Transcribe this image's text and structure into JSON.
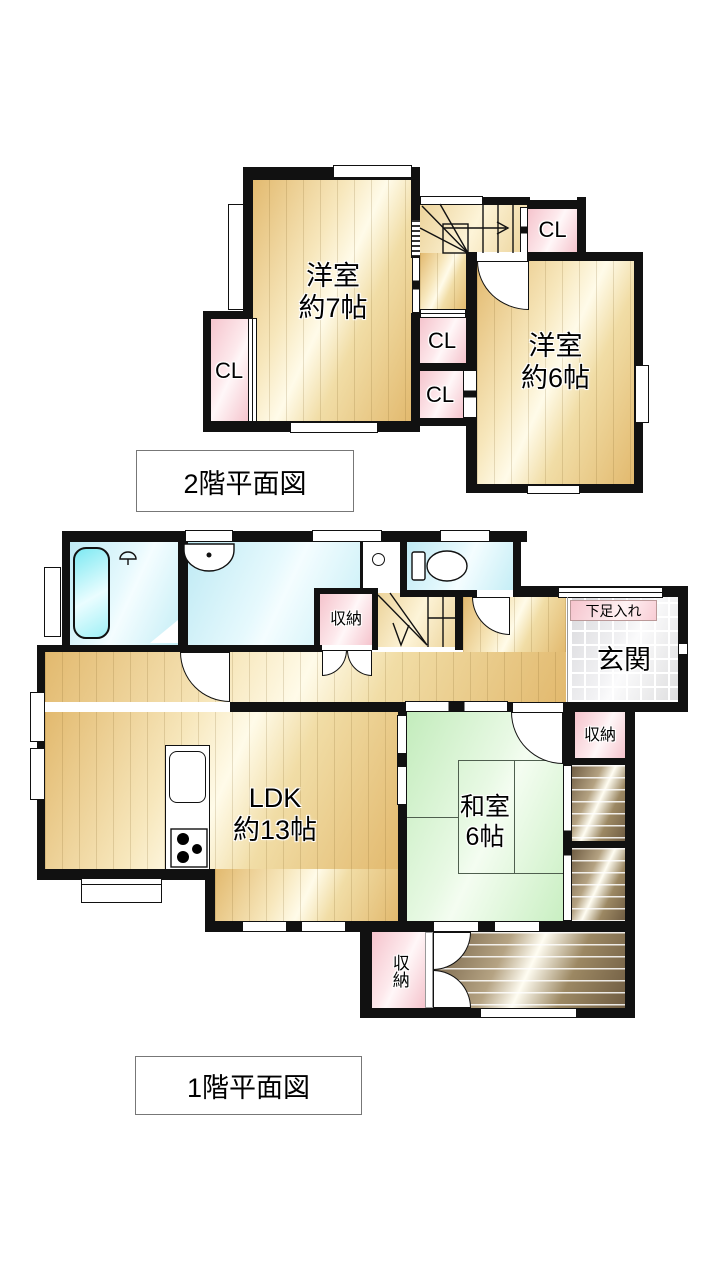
{
  "plan2f": {
    "title": "2階平面図",
    "rooms": {
      "west_bedroom": {
        "name": "洋室",
        "size": "約7帖"
      },
      "east_bedroom": {
        "name": "洋室",
        "size": "約6帖"
      }
    },
    "closet_label": "CL"
  },
  "plan1f": {
    "title": "1階平面図",
    "rooms": {
      "ldk": {
        "name": "LDK",
        "size": "約13帖"
      },
      "washitsu": {
        "name": "和室",
        "size": "6帖"
      },
      "genkan": "玄関",
      "shoe_box": "下足入れ"
    },
    "storage_label": "収納"
  },
  "colors": {
    "wall": "#111111",
    "floor_cream": "#f1dda6",
    "closet_pink": "#f5c3cc",
    "water_blue": "#c5eef6",
    "tatami_green": "#c9efc2",
    "veranda_brown": "#8d765a",
    "entrance_tile": "#e9e9ec"
  }
}
